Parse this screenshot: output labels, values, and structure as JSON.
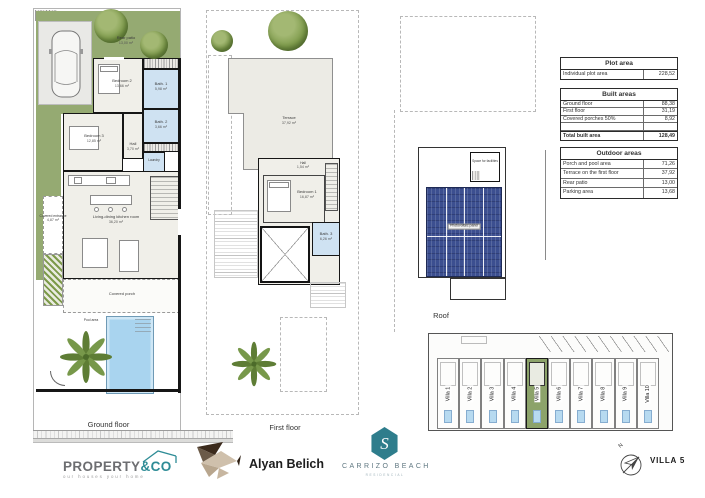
{
  "ground": {
    "caption": "Ground floor",
    "rear_patio_label": "Rear patio",
    "rear_patio_area": "13,00 m²",
    "bedroom2_label": "Bedroom 2",
    "bedroom2_area": "13,66 m²",
    "bedroom3_label": "Bedroom 3",
    "bedroom3_area": "12,85 m²",
    "bath1_label": "Bath. 1",
    "bath1_area": "5,98 m²",
    "bath2_label": "Bath. 2",
    "bath2_area": "3,66 m²",
    "hall_label": "Hall",
    "hall_area": "3,70 m²",
    "laundry_label": "Laundry",
    "living_label": "Living-dining kitchen room",
    "living_area": "36,20 m²",
    "entrance_label": "Covered entrance",
    "entrance_area": "4,87 m²",
    "porch_label": "Covered porch",
    "pool_label": "Pool area"
  },
  "first": {
    "caption": "First floor",
    "terrace_label": "Terrace",
    "terrace_area": "37,92 m²",
    "bedroom1_label": "Bedroom 1",
    "bedroom1_area": "16,87 m²",
    "bath3_label": "Bath. 3",
    "bath3_area": "6,26 m²",
    "hall_label": "Hall",
    "hall_area": "1,54 m²"
  },
  "roof": {
    "caption": "Roof",
    "facilities_label": "Space for facilities",
    "pv_label": "Photovoltaic panel"
  },
  "tables": {
    "plot": {
      "title": "Plot area",
      "rows": [
        {
          "label": "Individual plot area",
          "value": "228,52"
        }
      ]
    },
    "built": {
      "title": "Built areas",
      "rows": [
        {
          "label": "Ground floor",
          "value": "88,38"
        },
        {
          "label": "First floor",
          "value": "31,19"
        },
        {
          "label": "Covered porches 50%",
          "value": "8,92"
        },
        {
          "label": "",
          "value": ""
        },
        {
          "label": "Total built area",
          "value": "128,49"
        }
      ]
    },
    "outdoor": {
      "title": "Outdoor areas",
      "rows": [
        {
          "label": "Porch and pool area",
          "value": "71,26"
        },
        {
          "label": "Terrace on the first floor",
          "value": "37,92"
        },
        {
          "label": "Rear patio",
          "value": "13,00"
        },
        {
          "label": "Parking area",
          "value": "13,68"
        }
      ]
    }
  },
  "site": {
    "villas": [
      "Villa 1",
      "Villa 2",
      "Villa 3",
      "Villa 4",
      "Villa 5",
      "Villa 6",
      "Villa 7",
      "Villa 8",
      "Villa 9",
      "Villa 10"
    ],
    "highlighted": "Villa 5"
  },
  "branding": {
    "property_co_main": "PROPERTY",
    "property_co_accent": "&CO",
    "property_co_tagline": "our houses your home",
    "architect": "Alyan Belich",
    "residential_name": "CARRIZO BEACH",
    "residential_sub": "RESIDENCIAL",
    "monogram": "S"
  },
  "meta": {
    "villa_ref": "VILLA 5",
    "north_label": "N"
  },
  "colors": {
    "garden_green": "#95aa72",
    "pool_blue": "#a9d4ef",
    "bath_blue": "#cfe2f2",
    "room_beige": "#f0efe9",
    "solar_blue": "#3c4f90",
    "brand_teal": "#2e8c96"
  }
}
